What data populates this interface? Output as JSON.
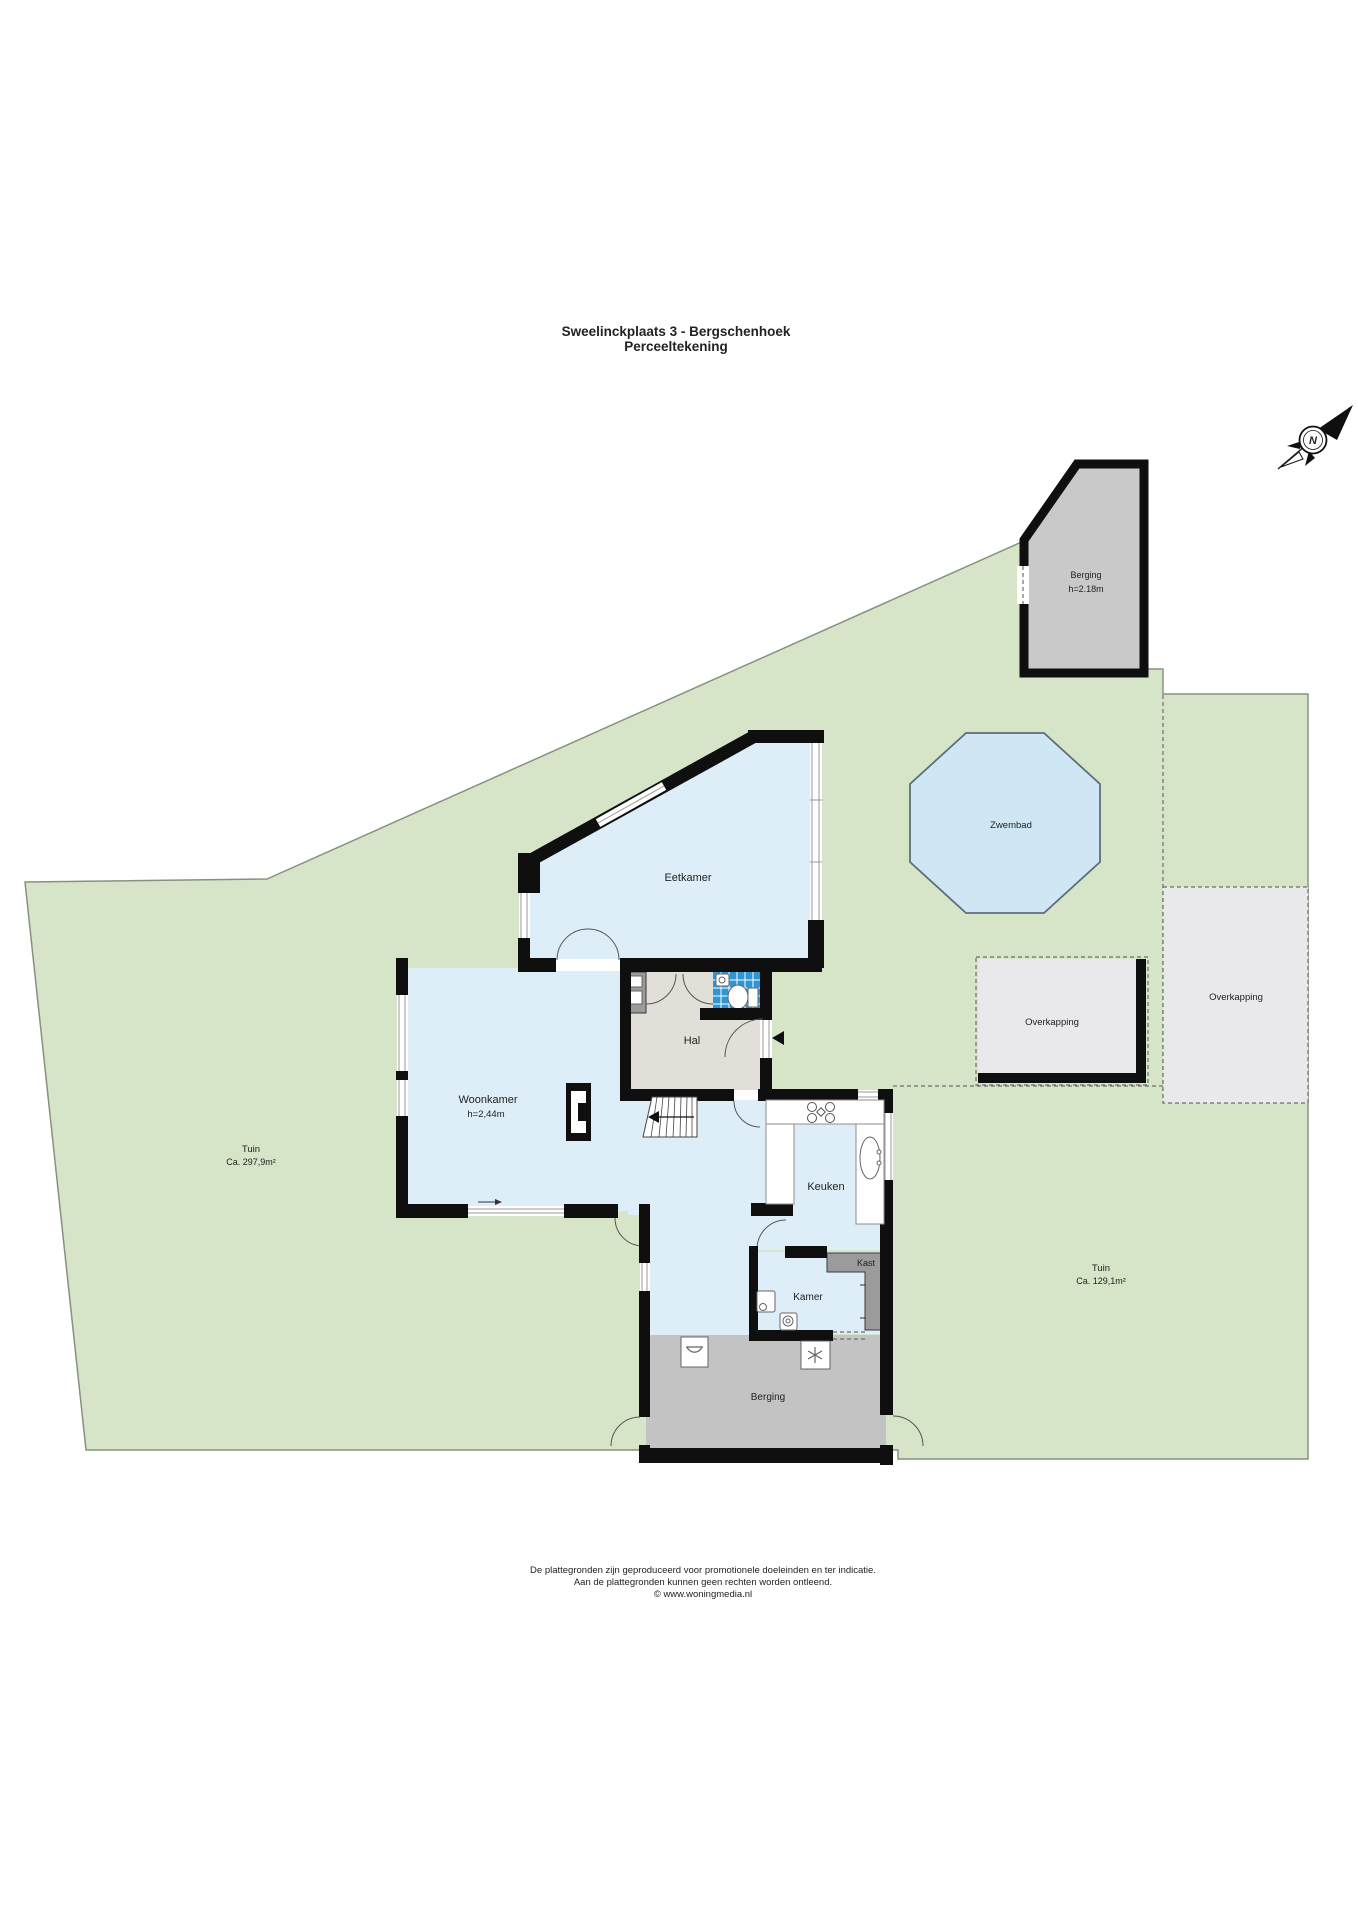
{
  "title": {
    "line1": "Sweelinckplaats 3 - Bergschenhoek",
    "line2": "Perceeltekening"
  },
  "compass": {
    "north_label": "N"
  },
  "site": {
    "tuin_left": {
      "name": "Tuin",
      "size": "Ca. 297,9m²"
    },
    "tuin_right": {
      "name": "Tuin",
      "size": "Ca. 129,1m²"
    },
    "zwembad": {
      "name": "Zwembad"
    },
    "overkapping_left": {
      "name": "Overkapping"
    },
    "overkapping_right": {
      "name": "Overkapping"
    },
    "berging_exterior": {
      "name": "Berging",
      "height": "h=2.18m"
    }
  },
  "rooms": {
    "eetkamer": {
      "name": "Eetkamer"
    },
    "woonkamer": {
      "name": "Woonkamer",
      "height": "h=2,44m"
    },
    "hal": {
      "name": "Hal"
    },
    "keuken": {
      "name": "Keuken"
    },
    "kamer": {
      "name": "Kamer"
    },
    "kast": {
      "name": "Kast"
    },
    "berging": {
      "name": "Berging"
    }
  },
  "footer": {
    "line1": "De plattegronden zijn geproduceerd voor promotionele doeleinden en ter indicatie.",
    "line2": "Aan de plattegronden kunnen geen rechten worden ontleend.",
    "line3": "© www.woningmedia.nl"
  },
  "colors": {
    "garden_green": "#d6e4c8",
    "garden_border": "#88917f",
    "floor_blue": "#ddeef8",
    "pool_blue": "#cfe7f4",
    "tile_blue": "#2e96d3",
    "hal_gray": "#e2dfd9",
    "storage_gray": "#c3c3c3",
    "shed_gray": "#c9c9c9",
    "closet_gray": "#9b9b9b",
    "canopy_gray": "#e9e9ec",
    "wall_black": "#0f0f0f"
  }
}
